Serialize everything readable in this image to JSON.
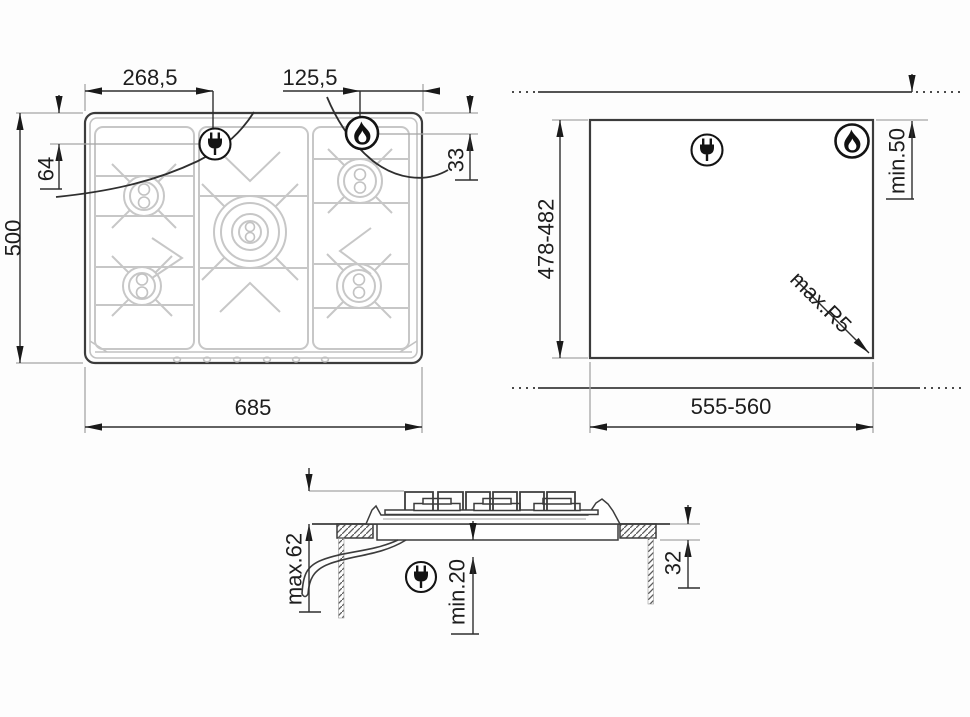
{
  "palette": {
    "line_dark": "#3c3c3c",
    "line_light": "#c7c7c7",
    "extension_gray": "#a5a5a5",
    "text": "#1d1d1d",
    "background": "#fdfdfd"
  },
  "icons": {
    "electric": "plug-icon",
    "gas": "flame-icon"
  },
  "views": {
    "hob_top": {
      "width_to_plug": "268,5",
      "flame_to_edge": "125,5",
      "top_to_plug": "64",
      "top_to_flame": "33",
      "depth": "500",
      "width": "685"
    },
    "cutout": {
      "depth_range": "478-482",
      "wall_min": "min.50",
      "corner_max_radius": "max.R5",
      "width_range": "555-560"
    },
    "section": {
      "max_below": "max.62",
      "min_clearance": "min.20",
      "recess_depth": "32"
    }
  }
}
